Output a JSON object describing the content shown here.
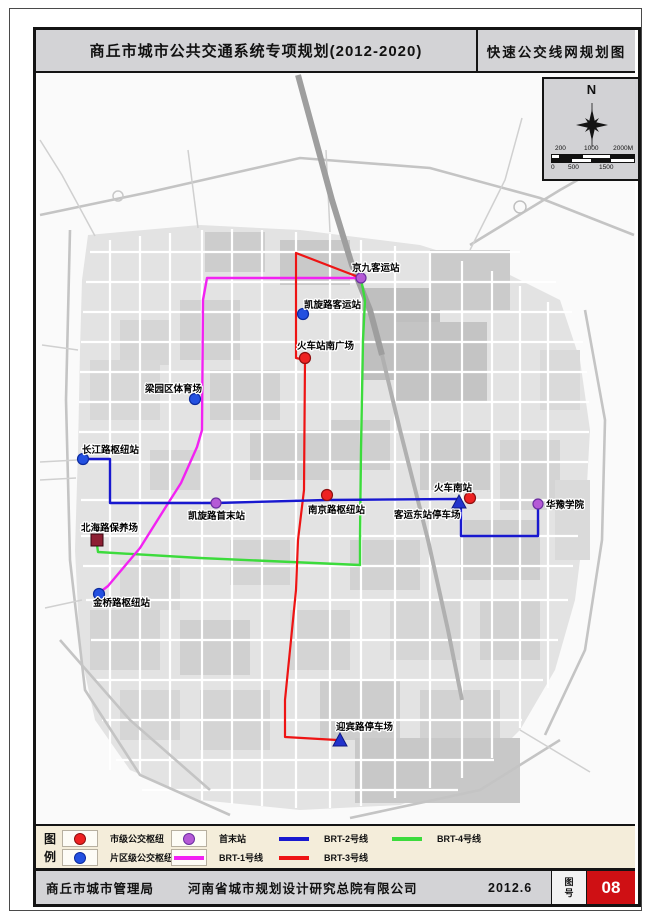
{
  "header": {
    "title_left": "商丘市城市公共交通系统专项规划(2012-2020)",
    "title_right": "快速公交线网规划图"
  },
  "compass": {
    "north": "N",
    "scale_top": [
      "200",
      "1000",
      "2000M"
    ],
    "scale_bottom": [
      "0",
      "500",
      "1500"
    ]
  },
  "map": {
    "stations": [
      {
        "name": "京九客运站",
        "type": "terminal"
      },
      {
        "name": "凯旋路客运站",
        "type": "district-hub"
      },
      {
        "name": "火车站南广场",
        "type": "city-hub"
      },
      {
        "name": "梁园区体育场",
        "type": "district-hub"
      },
      {
        "name": "长江路枢纽站",
        "type": "district-hub"
      },
      {
        "name": "凯旋路首末站",
        "type": "terminal"
      },
      {
        "name": "南京路枢纽站",
        "type": "city-hub"
      },
      {
        "name": "北海路保养场",
        "type": "depot"
      },
      {
        "name": "客运东站停车场",
        "type": "parking"
      },
      {
        "name": "火车南站",
        "type": "city-hub"
      },
      {
        "name": "华豫学院",
        "type": "terminal"
      },
      {
        "name": "金桥路枢纽站",
        "type": "district-hub"
      },
      {
        "name": "迎宾路停车场",
        "type": "parking"
      }
    ],
    "lines": [
      {
        "name": "BRT-1号线",
        "color": "#f222f2"
      },
      {
        "name": "BRT-2号线",
        "color": "#1818cf"
      },
      {
        "name": "BRT-3号线",
        "color": "#ee1414"
      },
      {
        "name": "BRT-4号线",
        "color": "#3cdb3c"
      }
    ]
  },
  "legend": {
    "heading_1": "图",
    "heading_2": "例",
    "items": [
      {
        "label": "市级公交枢纽",
        "symbol": "red-circle",
        "color": "#ee2222"
      },
      {
        "label": "首末站",
        "symbol": "purple-circle",
        "color": "#b55ad6"
      },
      {
        "label": "BRT-2号线",
        "symbol": "line",
        "color": "#1818cf"
      },
      {
        "label": "BRT-4号线",
        "symbol": "line",
        "color": "#3cdb3c"
      },
      {
        "label": "片区级公交枢纽",
        "symbol": "blue-circle",
        "color": "#2350e0"
      },
      {
        "label": "BRT-1号线",
        "symbol": "line",
        "color": "#f222f2"
      },
      {
        "label": "BRT-3号线",
        "symbol": "line",
        "color": "#ee1414"
      }
    ]
  },
  "footer": {
    "agency": "商丘市城市管理局",
    "designer": "河南省城市规划设计研究总院有限公司",
    "date": "2012.6",
    "sheet_label_1": "图",
    "sheet_label_2": "号",
    "sheet_no": "08"
  }
}
